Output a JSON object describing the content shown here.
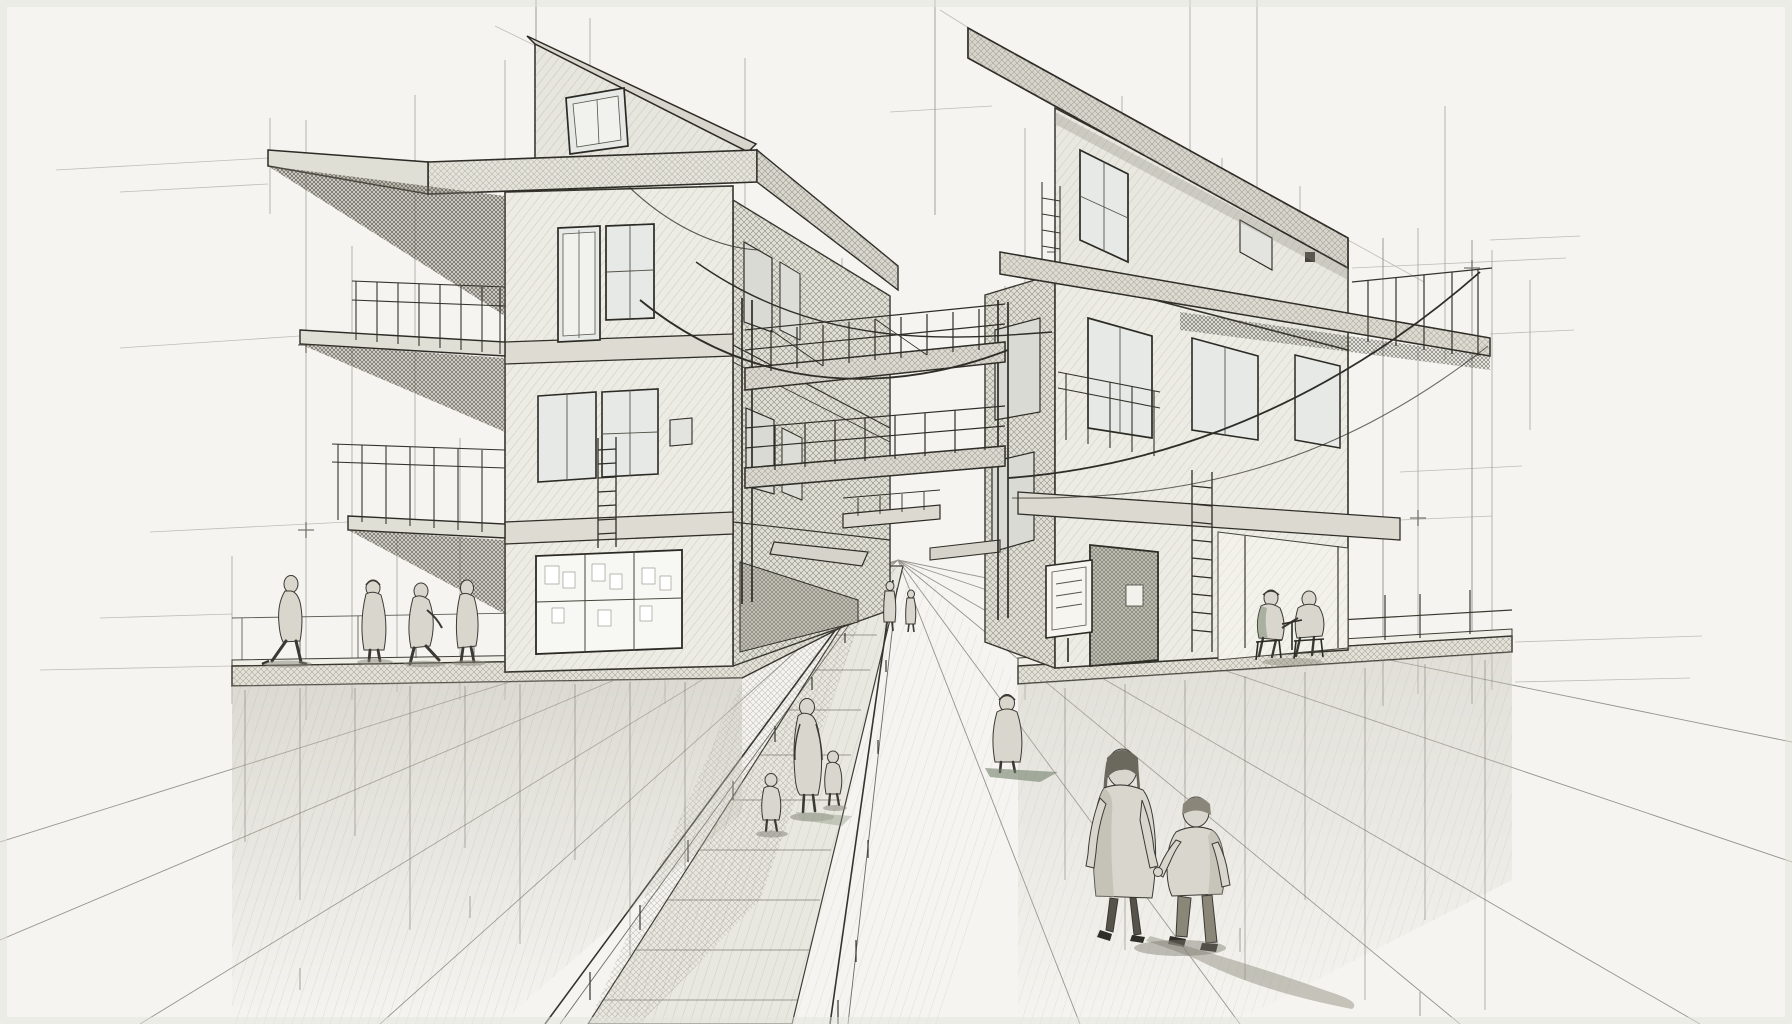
{
  "artwork": {
    "title": "Pencil architectural sketch: two cantilevered houses over a receding street with pedestrians",
    "style": "two-point perspective concept drawing with exploratory construction lines and crosshatch shading",
    "medium": "graphite pencil on paper"
  },
  "palette": {
    "paper": "#f5f4f0",
    "ink": "#383730",
    "ink_light": "#8e8c80",
    "face_light": "#edece4",
    "face_medium": "#e1e0d6",
    "face_dark": "#d6d4ca",
    "glass": "#e7e9e6",
    "lit_window": "#f7f7f3",
    "shadow": "#b7b5a9",
    "figure": "#d9d7cd",
    "figure_dark": "#57554b",
    "accent_green": "#72806a"
  },
  "scene": {
    "vanishing_point": {
      "x": 898,
      "y": 558
    },
    "buildings": [
      {
        "id": "left-house",
        "position": "left",
        "floors": 3,
        "features": [
          "mono-pitch attic gable with small window",
          "wide cantilevered roof slab",
          "stacked left balconies with thin railings",
          "paper-covered shop window at ground level",
          "bench and stool at plaza corner",
          "wall ladder"
        ]
      },
      {
        "id": "right-house",
        "position": "right",
        "floors": 3,
        "features": [
          "steep slanted cantilever roof",
          "long balcony slab extending right on thin posts",
          "entry door with plaque",
          "free-standing signboard",
          "wall ladder",
          "covered terrace with seated pair"
        ]
      }
    ],
    "bridges": [
      {
        "id": "upper-bridge",
        "level": 2,
        "railing": true
      },
      {
        "id": "lower-bridge",
        "level": 1,
        "railing": true
      },
      {
        "id": "far-connector",
        "level": 0,
        "railing": true
      }
    ],
    "street": {
      "description": "central walkway receding to vanishing point between the two houses, flanked by post-and-wire fences and fanning perspective guide lines"
    },
    "figures": [
      {
        "id": "left-walkers",
        "description": "four pedestrians crossing the left plaza",
        "count": 4,
        "x": 280,
        "y": 660
      },
      {
        "id": "street-family",
        "description": "parent walking with two small children on walkway",
        "count": 3,
        "x": 800,
        "y": 790
      },
      {
        "id": "lone-walker",
        "description": "hooded walker mid-street",
        "count": 1,
        "x": 1007,
        "y": 760
      },
      {
        "id": "foreground-pair",
        "description": "woman and boy holding hands walking away",
        "count": 2,
        "x": 1160,
        "y": 940
      },
      {
        "id": "seated-pair",
        "description": "two people seated on stools under the right terrace",
        "count": 2,
        "x": 1290,
        "y": 650
      },
      {
        "id": "distant-figures",
        "description": "small figures near the vanishing point",
        "count": 2,
        "x": 900,
        "y": 620
      }
    ]
  }
}
